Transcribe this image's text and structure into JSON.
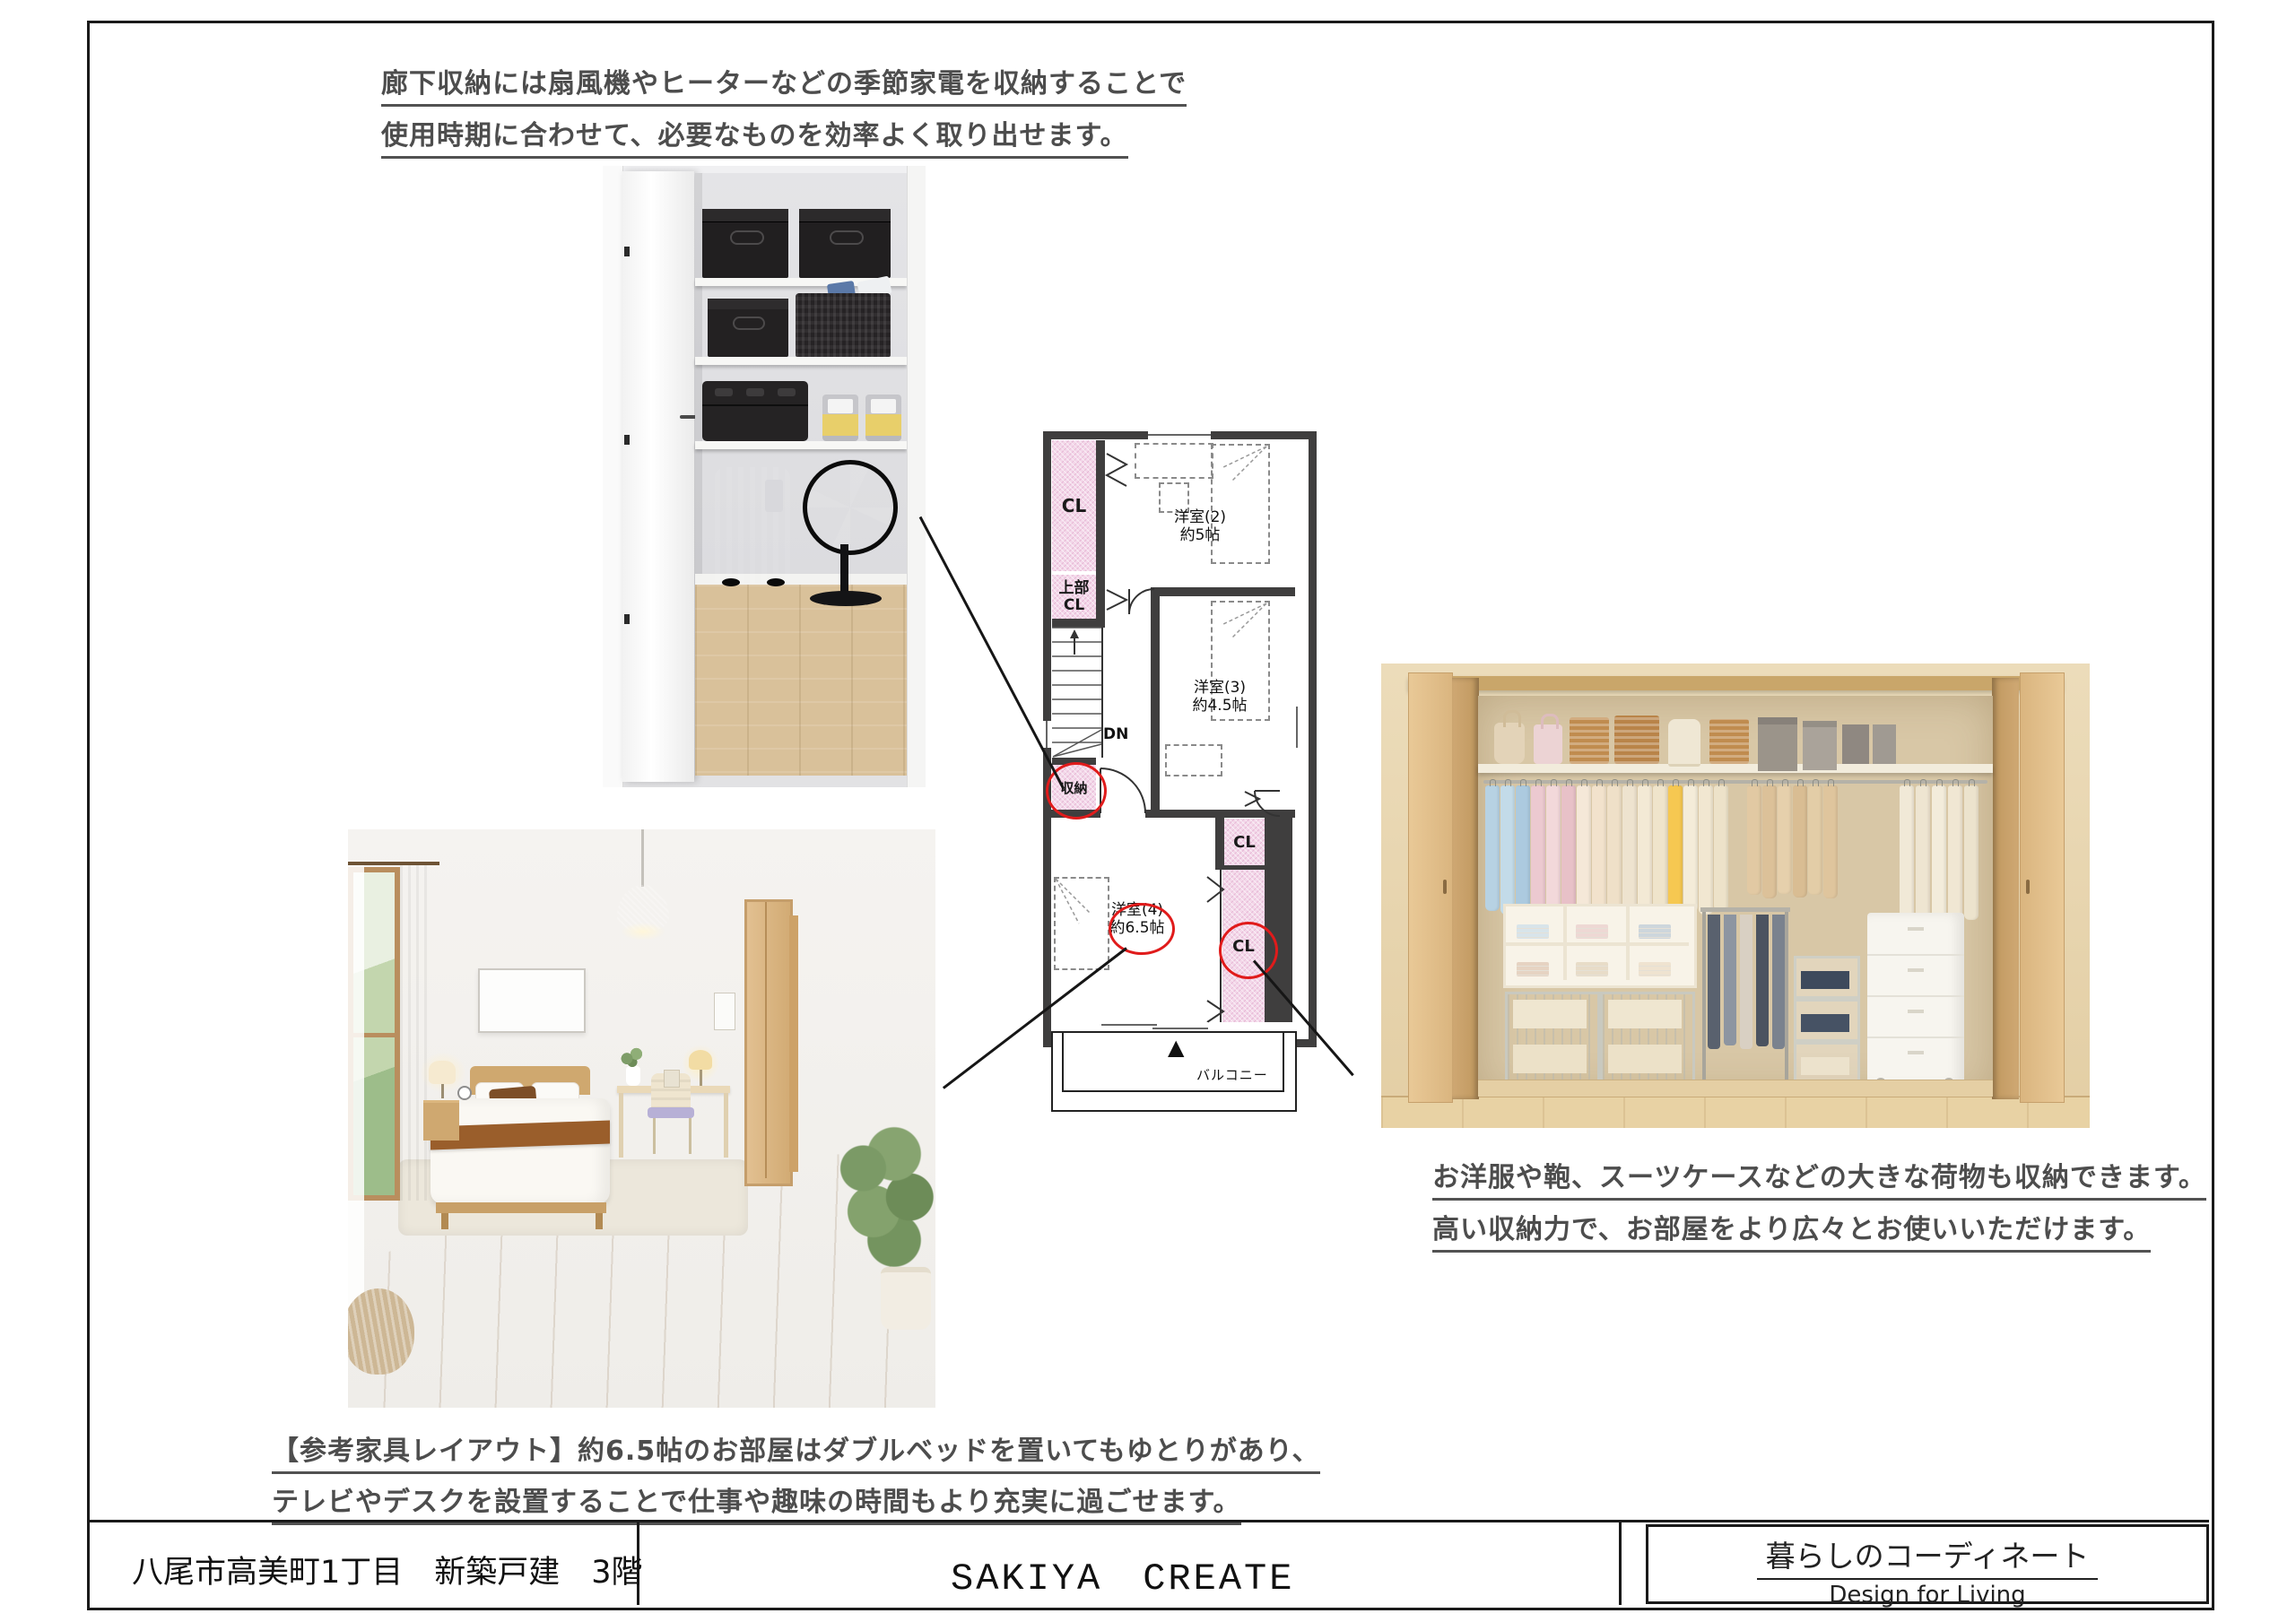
{
  "captions": {
    "top": {
      "line1": "廊下収納には扇風機やヒーターなどの季節家電を収納することで",
      "line2": "使用時期に合わせて、必要なものを効率よく取り出せます。"
    },
    "closet": {
      "line1": "お洋服や鞄、スーツケースなどの大きな荷物も収納できます。",
      "line2": "高い収納力で、お部屋をより広々とお使いいただけます。"
    },
    "bedroom": {
      "line1": "【参考家具レイアウト】約6.5帖のお部屋はダブルベッドを置いてもゆとりがあり、",
      "line2": "テレビやデスクを設置することで仕事や趣味の時間もより充実に過ごせます。"
    }
  },
  "floor_plan": {
    "rooms": [
      {
        "name": "洋室(2)",
        "size": "約5帖"
      },
      {
        "name": "洋室(3)",
        "size": "約4.5帖"
      },
      {
        "name": "洋室(4)",
        "size": "約6.5帖"
      }
    ],
    "labels": {
      "cl": "CL",
      "upper_cl_top": "上部",
      "upper_cl_bottom": "CL",
      "storage": "収納",
      "down": "DN",
      "balcony": "バルコニー",
      "north_mark": "▲"
    }
  },
  "footer": {
    "address": "八尾市高美町1丁目　新築戸建　3階",
    "company": "SAKIYA　CREATE",
    "brand_jp": "暮らしのコーディネート",
    "brand_en": "Design for Living"
  },
  "colors": {
    "closet_pink": "#f3d7e9",
    "wall_dark": "#3f3e3e",
    "highlight_red": "#e01b1b",
    "caption_gray": "#4d4d4d"
  }
}
